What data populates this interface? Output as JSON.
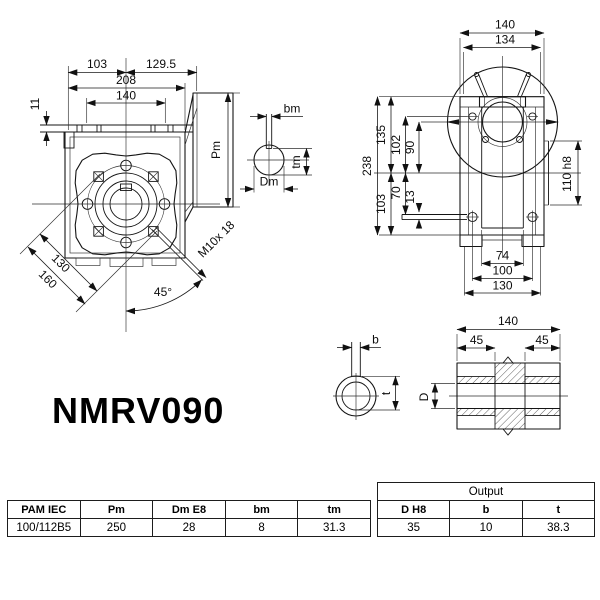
{
  "title": "NMRV090",
  "front_view": {
    "dim_103": "103",
    "dim_129_5": "129.5",
    "dim_208": "208",
    "dim_140": "140",
    "dim_11": "11",
    "dim_130": "130",
    "dim_160": "160",
    "angle_45": "45°",
    "thread": "M10x 18",
    "pm": "Pm"
  },
  "input_shaft": {
    "bm": "bm",
    "tm": "tm",
    "dm": "Dm"
  },
  "side_view": {
    "dim_140": "140",
    "dim_134": "134",
    "dim_238": "238",
    "dim_135": "135",
    "dim_102": "102",
    "dim_90": "90",
    "dim_103": "103",
    "dim_70": "70",
    "dim_13": "13",
    "dim_110h8": "110 h8",
    "dim_74": "74",
    "dim_100": "100",
    "dim_130": "130"
  },
  "output_shaft": {
    "dim_140": "140",
    "dim_45a": "45",
    "dim_45b": "45",
    "d": "D",
    "b": "b",
    "t": "t"
  },
  "pam_table": {
    "headers": [
      "PAM IEC",
      "Pm",
      "Dm E8",
      "bm",
      "tm"
    ],
    "row": [
      "100/112B5",
      "250",
      "28",
      "8",
      "31.3"
    ]
  },
  "output_table": {
    "title": "Output",
    "headers": [
      "D H8",
      "b",
      "t"
    ],
    "row": [
      "35",
      "10",
      "38.3"
    ]
  }
}
